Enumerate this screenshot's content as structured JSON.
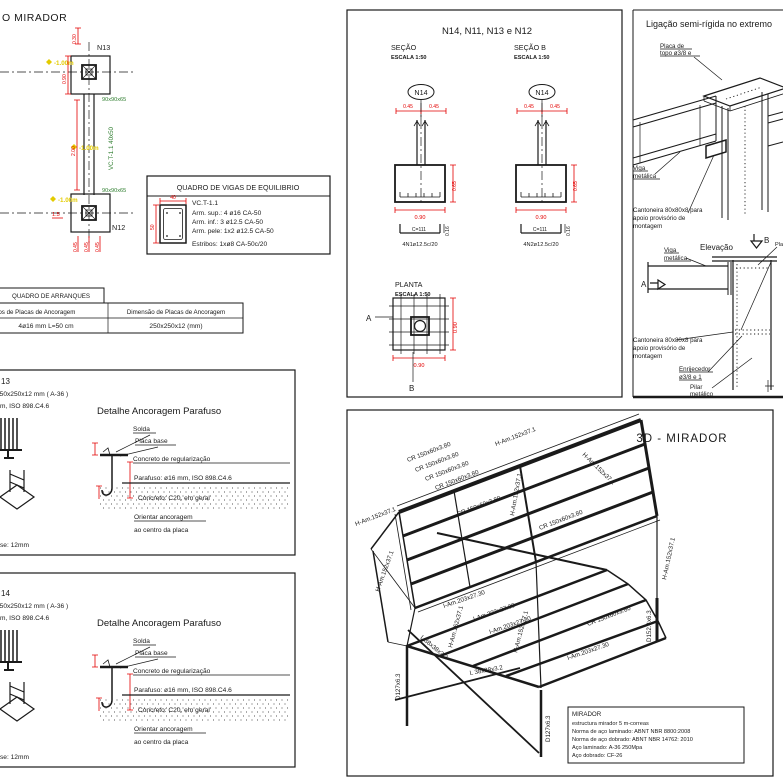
{
  "plan": {
    "title": "O MIRADOR",
    "n13": "N13",
    "n12": "N12",
    "footing": "90x90x65",
    "beam": "VC.T-1.1 40x50",
    "elev": "-1.00m",
    "dim_090": "0.90",
    "dim_030": "0.30",
    "dim_200": "2.00",
    "dim_045": "0.45",
    "dim_15": "1.5"
  },
  "quadro_vigas": {
    "title": "QUADRO DE VIGAS DE EQUILIBRIO",
    "name": "VC.T-1.1",
    "sup": "Arm. sup.: 4 ø16 CA-50",
    "inf": "Arm. inf.: 3 ø12.5 CA-50",
    "pele": "Arm. pele: 1x2 ø12.5 CA-50",
    "estribos": "Estribos: 1xø8 CA-50c/20",
    "dim_w": "40",
    "dim_h": "50"
  },
  "quadro_arranques": {
    "title": "QUADRO DE ARRANQUES",
    "col1": "Parafusos de Placas de Ancoragem",
    "col2": "Dimensão de Placas de Ancoragem",
    "val1": "4ø16 mm L=50 cm",
    "val2": "250x250x12 (mm)"
  },
  "detail": {
    "plate": "250x250x12 mm ( A-36 )",
    "bolt_frag": "m, ISO 898.C4.6",
    "heading": "Detalhe Ancoragem Parafuso",
    "solda": "Solda",
    "placa_base": "Placa base",
    "concreto_reg": "Concreto de regularização",
    "parafuso": "Parafuso: ø16 mm, ISO 898.C4.6",
    "concreto_c20": "Concreto: C20, em geral",
    "orientar1": "Orientar ancoragem",
    "orientar2": "ao centro da placa",
    "base_frag": "se: 12mm"
  },
  "detail_n13": {
    "node": "13"
  },
  "detail_n14": {
    "node": "14"
  },
  "sections": {
    "title": "N14, N11, N13 e N12",
    "sec_a": "SEÇÃO",
    "sec_b": "SEÇÃO B",
    "escala": "ESCALA 1:50",
    "bubble": "N14",
    "dim_045": "0.45",
    "dim_065": "0.65",
    "dim_090": "0.90",
    "c_label": "C=111",
    "c_dim": "0.16",
    "rebar_a": "4N1ø12.5c/20",
    "rebar_b": "4N2ø12.5c/20",
    "planta": "PLANTA",
    "mark_a": "A",
    "mark_b": "B"
  },
  "ligacao": {
    "title": "Ligação semi-rígida no extremo",
    "placa1": "Placa de",
    "placa2": "topo ø3/8 e",
    "viga1": "Viga",
    "viga2": "metálica",
    "cant1": "Cantoneira 80x80x8 para",
    "cant2": "apoio provisório de",
    "cant3": "montagem",
    "elevacao": "Elevação",
    "mark_a": "A",
    "mark_b": "B",
    "enrij1": "Enrijecedor",
    "enrij2": "ø3/8 e 1",
    "pilar1": "Pilar",
    "pilar2": "metálico",
    "placa_cut": "Placa de"
  },
  "m3d": {
    "title": "3D - MIRADOR",
    "cr": "CR 150x60x3.80",
    "h": "H-Am.152x37.1",
    "i": "I-Am.203x27.30",
    "l": "L 38x38x3.2",
    "d127": "D127x6.3",
    "d152": "D152.4x6.3",
    "notes": {
      "t": "MIRADOR",
      "l1": "estructura mirador 5 m-correas",
      "l2": "Norma de aço laminado: ABNT NBR 8800:2008",
      "l3": "Norma de aço dobrado: ABNT NBR 14762: 2010",
      "l4": "Aço laminado: A-36 250Mpa",
      "l5": "Aço dobrado: CF-26"
    }
  }
}
